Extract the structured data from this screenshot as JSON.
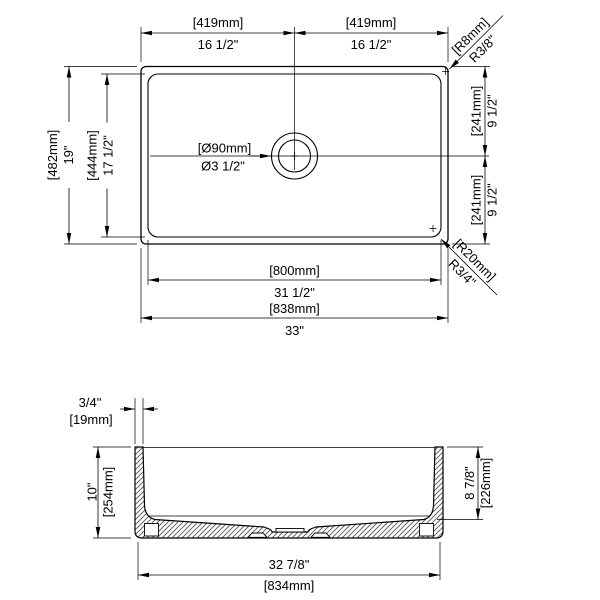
{
  "drawing": {
    "top_view": {
      "dim_half_width_left": {
        "mm": "[419mm]",
        "inch": "16 1/2\""
      },
      "dim_half_width_right": {
        "mm": "[419mm]",
        "inch": "16 1/2\""
      },
      "rim_corner_radius": {
        "mm": "[R8mm]",
        "inch": "R3/8\""
      },
      "dim_outer_front_to_back": {
        "mm": "[482mm]",
        "inch": "19\""
      },
      "dim_bowl_front_to_back": {
        "mm": "[444mm]",
        "inch": "17 1/2\""
      },
      "drain_diameter": {
        "mm": "[Ø90mm]",
        "inch": "Ø3 1/2\""
      },
      "dim_drain_offset_upper": {
        "mm": "[241mm]",
        "inch": "9 1/2\""
      },
      "dim_drain_offset_lower": {
        "mm": "[241mm]",
        "inch": "9 1/2\""
      },
      "bowl_corner_radius": {
        "mm": "[R20mm]",
        "inch": "R3/4\""
      },
      "dim_bowl_width": {
        "mm": "[800mm]",
        "inch": "31 1/2\""
      },
      "dim_overall_width": {
        "mm": "[838mm]",
        "inch": "33\""
      }
    },
    "front_view": {
      "dim_wall_thickness": {
        "inch": "3/4\"",
        "mm": "[19mm]"
      },
      "dim_overall_height": {
        "inch": "10\"",
        "mm": "[254mm]"
      },
      "dim_bowl_depth": {
        "inch": "8 7/8\"",
        "mm": "[226mm]"
      },
      "dim_bottom_width": {
        "inch": "32 7/8\"",
        "mm": "[834mm]"
      }
    }
  },
  "colors": {
    "line": "#000000",
    "hatch_line": "#555555",
    "background": "#ffffff"
  }
}
